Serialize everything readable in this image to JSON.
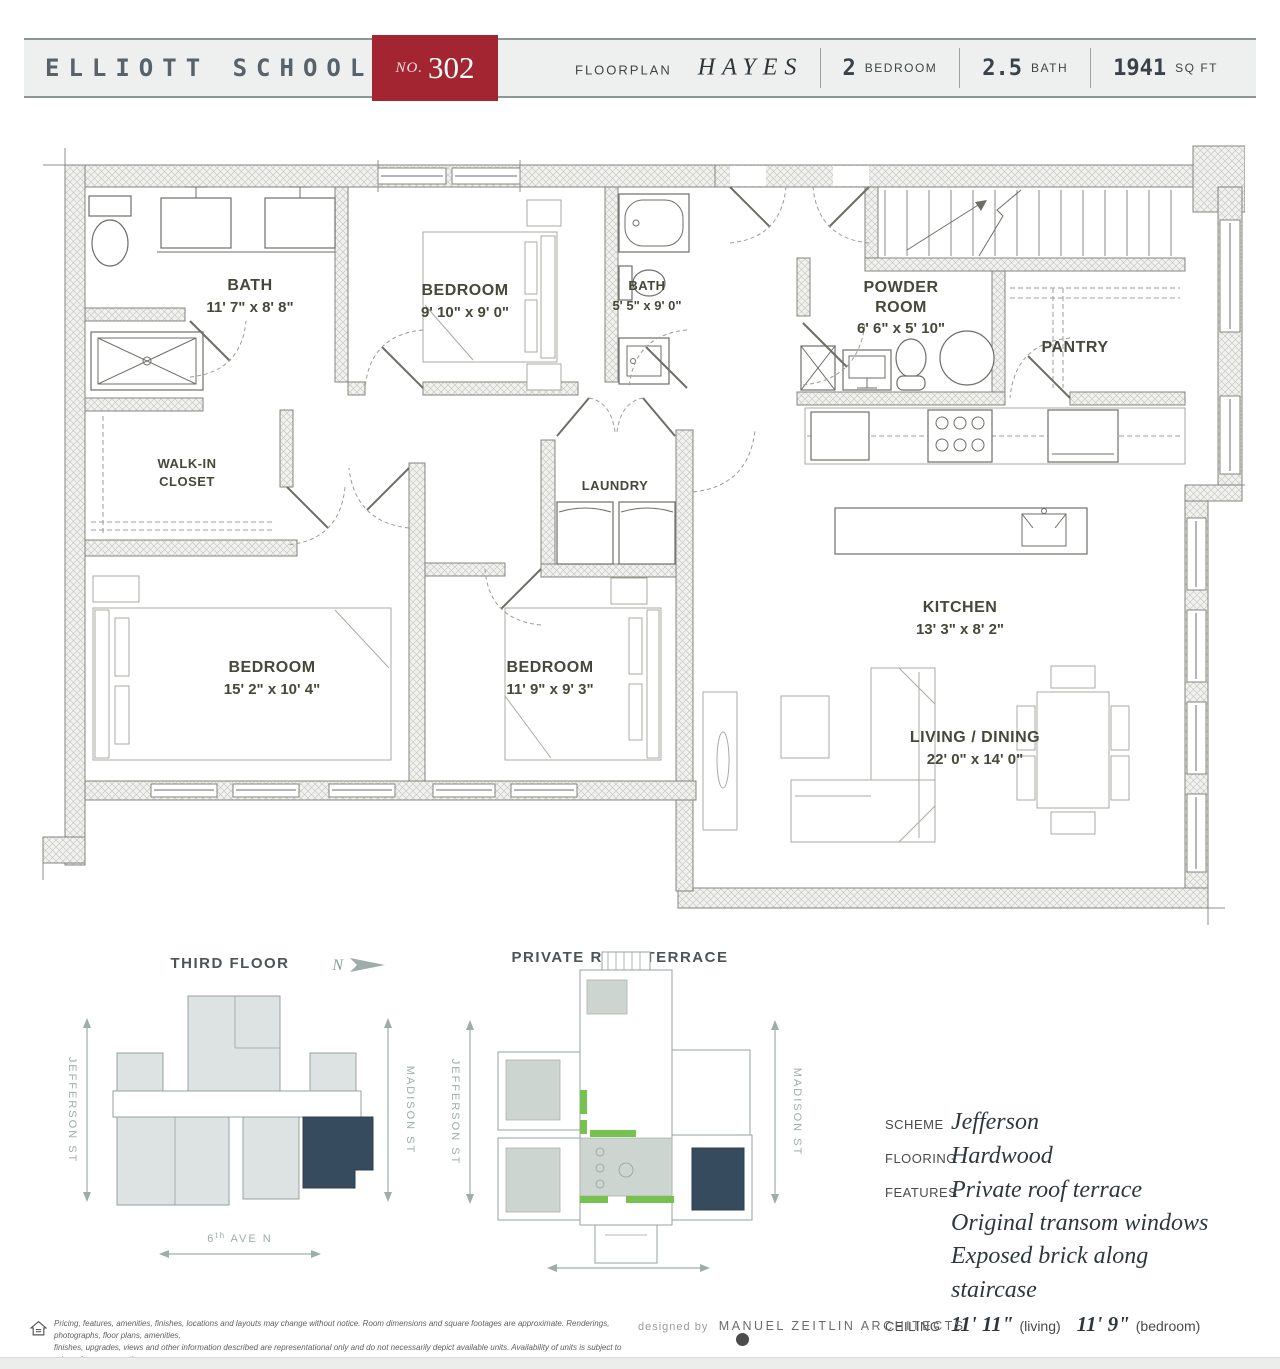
{
  "header": {
    "building": "ELLIOTT SCHOOL",
    "unit_label": "NO.",
    "unit_number": "302",
    "floorplan_label": "FLOORPLAN",
    "floorplan_name": "HAYES",
    "stats": [
      {
        "value": "2",
        "unit": "BEDROOM"
      },
      {
        "value": "2.5",
        "unit": "BATH"
      },
      {
        "value": "1941",
        "unit": "SQ FT"
      }
    ]
  },
  "plan": {
    "bath1": {
      "name": "BATH",
      "dims": "11' 7\" x 8' 8\""
    },
    "bed1": {
      "name": "BEDROOM",
      "dims": "9' 10\" x 9' 0\""
    },
    "bath2": {
      "name": "BATH",
      "dims": "5' 5\" x 9' 0\""
    },
    "powder": {
      "line1": "POWDER",
      "line2": "ROOM",
      "dims": "6' 6\" x 5' 10\""
    },
    "pantry": {
      "name": "PANTRY"
    },
    "closet": {
      "line1": "WALK-IN",
      "line2": "CLOSET"
    },
    "laundry": {
      "name": "LAUNDRY"
    },
    "bed2": {
      "name": "BEDROOM",
      "dims": "15' 2\" x 10' 4\""
    },
    "bed3": {
      "name": "BEDROOM",
      "dims": "11' 9\" x 9' 3\""
    },
    "kitchen": {
      "name": "KITCHEN",
      "dims": "13' 3\" x 8' 2\""
    },
    "living": {
      "name": "LIVING / DINING",
      "dims": "22' 0\" x 14' 0\""
    }
  },
  "site_plans": {
    "third_floor": {
      "title": "THIRD FLOOR",
      "north_label": "N"
    },
    "roof_terrace": {
      "title": "PRIVATE ROOF TERRACE"
    },
    "streets": {
      "left": "JEFFERSON ST",
      "right": "MADISON ST",
      "bottom_num": "6",
      "bottom_sup": "th",
      "bottom_rest": " AVE N"
    }
  },
  "details": {
    "scheme_label": "SCHEME",
    "scheme": "Jefferson",
    "flooring_label": "FLOORING",
    "flooring": "Hardwood",
    "features_label": "FEATURES",
    "feature1": "Private roof terrace",
    "feature2": "Original transom windows",
    "feature3": "Exposed brick along staircase",
    "ceiling_label": "CEILING",
    "ceiling1_value": "11' 11\"",
    "ceiling1_note": "(living)",
    "ceiling2_value": "11' 9\"",
    "ceiling2_note": "(bedroom)"
  },
  "footer": {
    "disclaimer_line1": "Pricing, features, amenities, finishes, locations and layouts may change without notice. Room dimensions and square footages are approximate. Renderings, photographs, floor plans, amenities,",
    "disclaimer_line2": "finishes, upgrades, views and other information described are representational only and do not necessarily depict available units. Availability of units is subject to prior sales or reservations.",
    "designed_by": "designed by",
    "architect": "MANUEL ZEITLIN ARCHITECTS"
  },
  "colors": {
    "accent_red": "#a32531",
    "unit_highlight_navy": "#374b5e",
    "site_block_fill": "#dde3e2",
    "terrace_green": "#76c14f",
    "plan_label_olive": "#45483a"
  }
}
